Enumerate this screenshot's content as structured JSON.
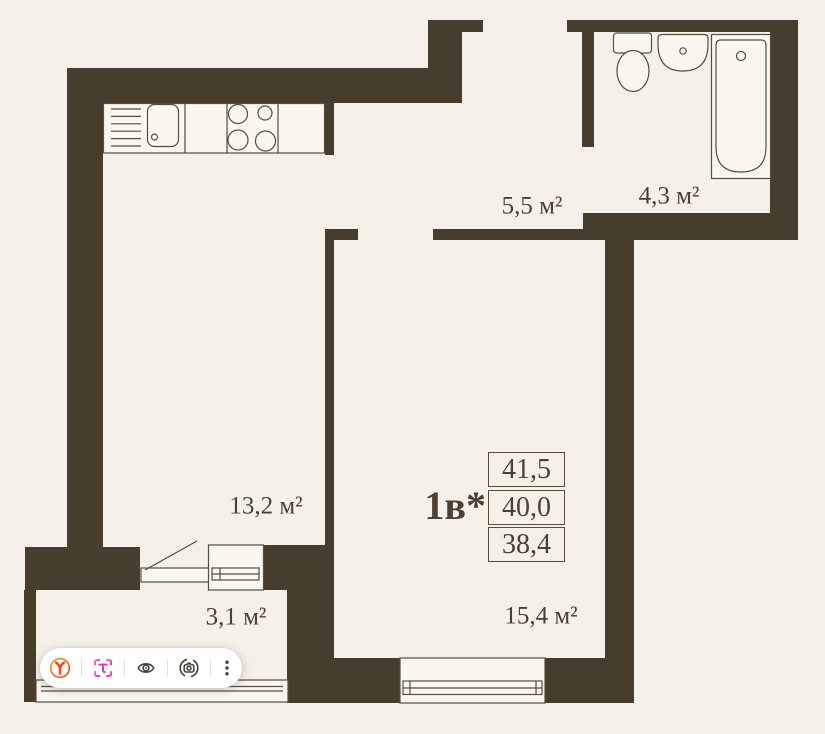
{
  "colors": {
    "background": "#f5f1e8",
    "wall": "#473d2f",
    "stroke": "#584c3b",
    "fixture": "#faf7f0",
    "text": "#4a4033",
    "toolbar_bg": "#ffffff",
    "separator": "#e3dfd8",
    "icon_gray": "#454039",
    "yandex_red": "#fc3f1d",
    "yandex_ring_orange": "#ff9e22",
    "translate_pink": "#e8399f",
    "translate_magenta": "#d932c8"
  },
  "floor_plan": {
    "unit_label": "1в*",
    "area_values": [
      "41,5",
      "40,0",
      "38,4"
    ],
    "room_labels": {
      "living": "13,2 м²",
      "hall": "5,5 м²",
      "bathroom": "4,3 м²",
      "balcony": "3,1 м²",
      "bedroom": "15,4 м²"
    }
  },
  "toolbar": {
    "icons": [
      {
        "name": "yandex-logo-icon"
      },
      {
        "name": "screen-translate-icon"
      },
      {
        "name": "hide-overlay-eye-icon"
      },
      {
        "name": "image-search-camera-icon"
      },
      {
        "name": "more-options-icon"
      }
    ]
  }
}
